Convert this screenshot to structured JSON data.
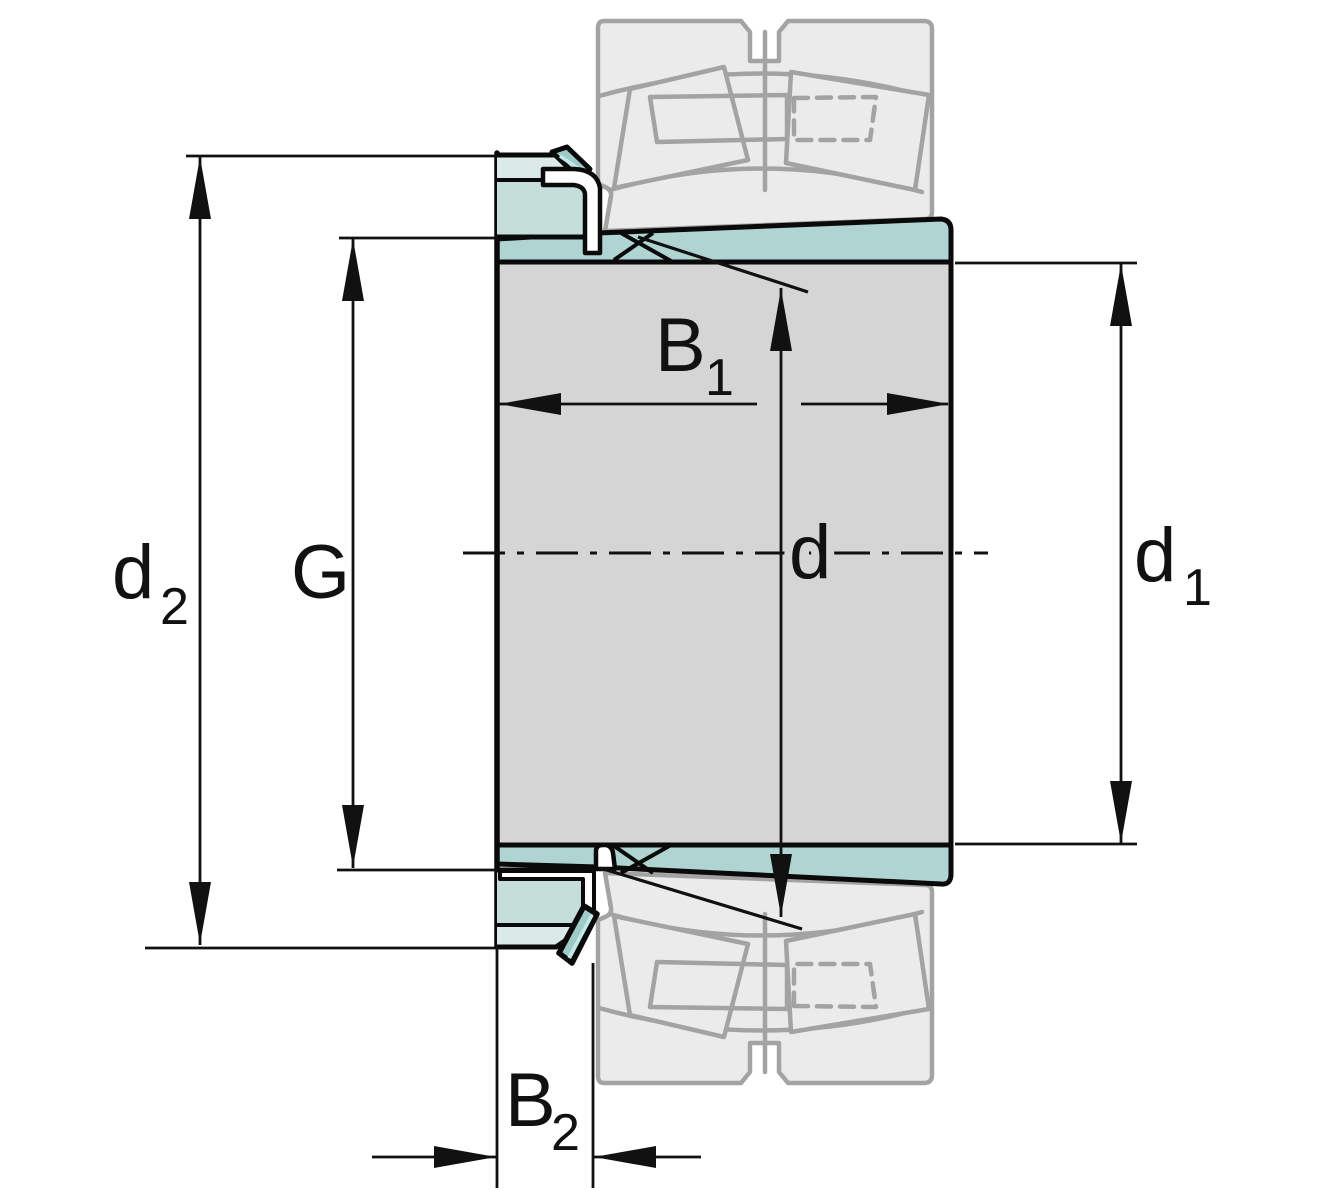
{
  "title": "Adapter sleeve with spherical roller bearing — dimension drawing",
  "diagram": {
    "type": "technical-drawing",
    "component": "adapter-sleeve-assembly",
    "labels": {
      "d2": {
        "base": "d",
        "sub": "2"
      },
      "g": {
        "base": "G",
        "sub": ""
      },
      "b1": {
        "base": "B",
        "sub": "1"
      },
      "d": {
        "base": "d",
        "sub": ""
      },
      "d1": {
        "base": "d",
        "sub": "1"
      },
      "b2": {
        "base": "B",
        "sub": "2"
      }
    },
    "colors": {
      "outline": "#0a0a0a",
      "sleeve-gray": "#d5d5d5",
      "band-teal": "#afd4d1",
      "nut-body": "#c6ded9",
      "nut-light": "#dbeae6",
      "tab-teal": "#9ecbc8",
      "tab-highlight": "#c4e9e9",
      "bearing-fill": "#ebebeb",
      "bearing-stroke": "#a3a3a3"
    }
  }
}
